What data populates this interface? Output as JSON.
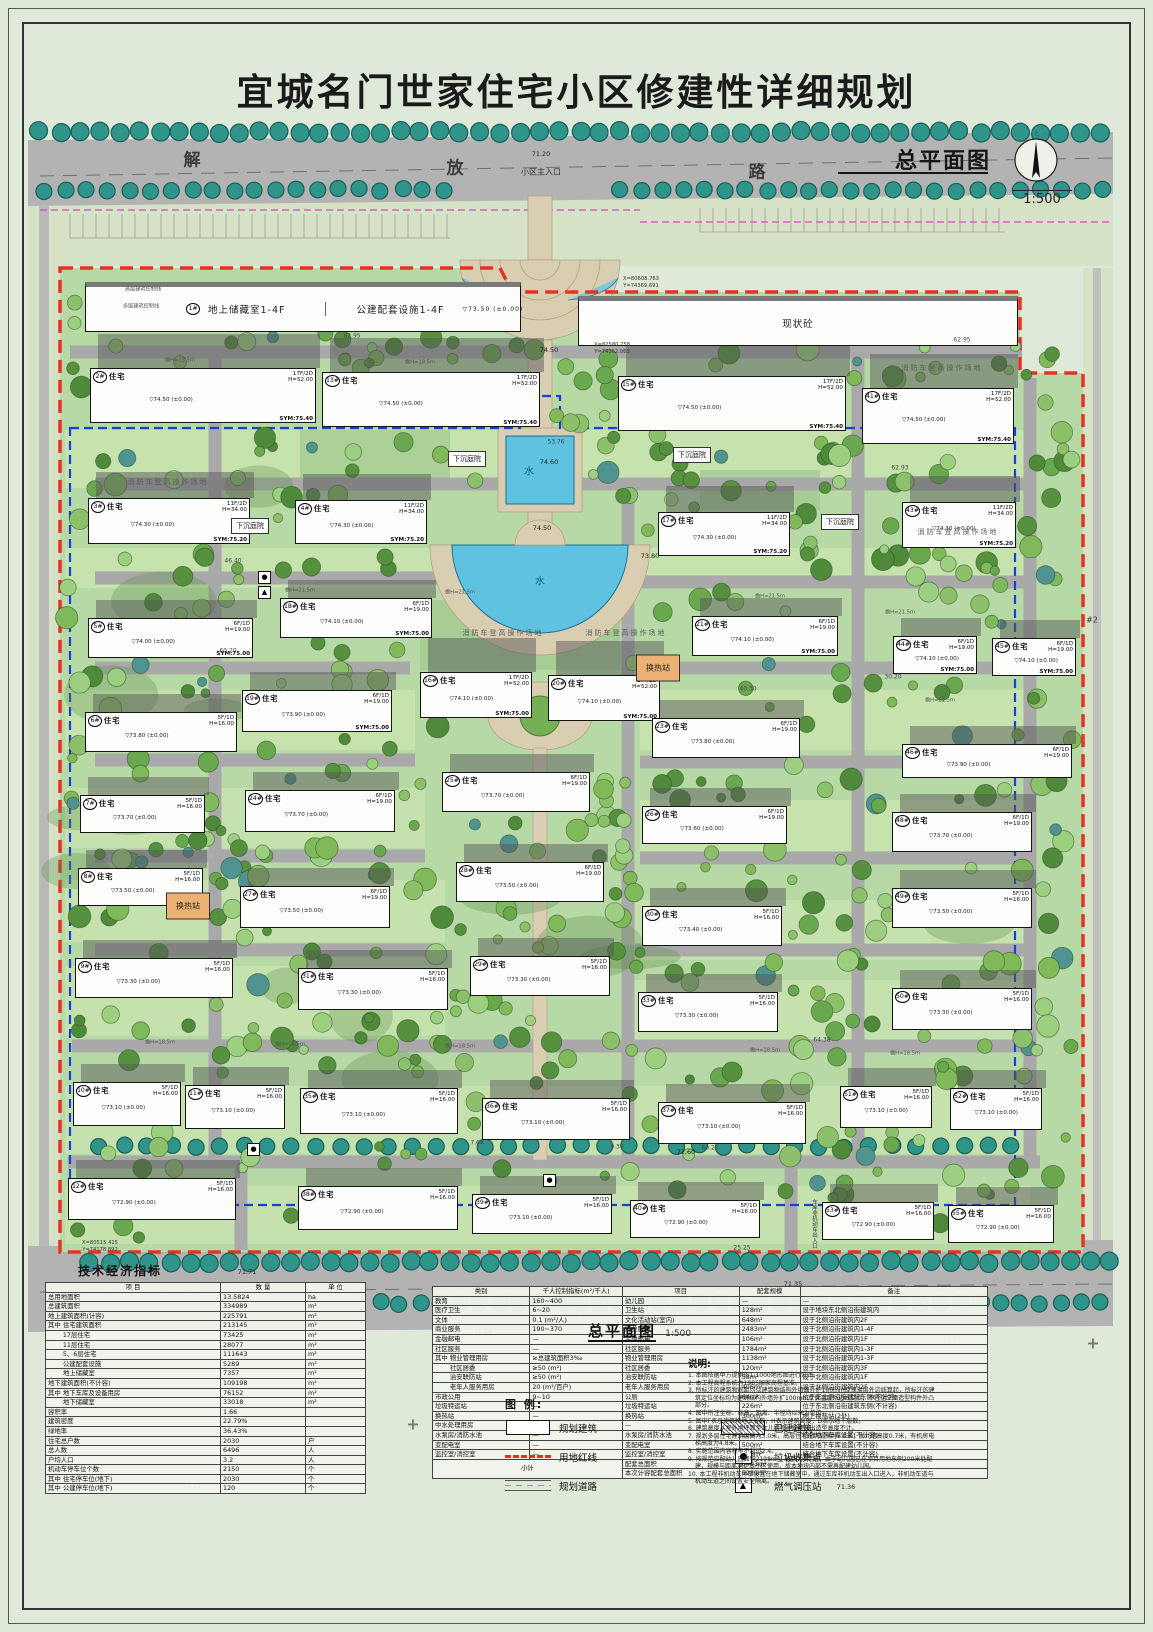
{
  "title": "宜城名门世家住宅小区修建性详细规划",
  "plan_label": {
    "name": "总平面图",
    "scale": "1:500",
    "north": "北"
  },
  "subtitle": {
    "name": "总平面图",
    "scale": "1:500"
  },
  "road": {
    "name": "解放路",
    "c1": "解",
    "c2": "放",
    "c3": "路"
  },
  "building_type": "住宅",
  "base_mark": "(±0.00)",
  "storage": {
    "num": "1#",
    "label1": "地上储藏室1-4F",
    "label2": "公建配套设施1-4F",
    "elev": "▽73.50 (±0.00)"
  },
  "existing": {
    "label": "现状砼"
  },
  "buildings": [
    {
      "n": "2#",
      "x": 90,
      "y": 368,
      "w": 226,
      "h": 55,
      "f": "17F/2D",
      "ht": "H=52.00",
      "e": "74.50",
      "s": "SYM:75.40"
    },
    {
      "n": "13#",
      "x": 322,
      "y": 372,
      "w": 218,
      "h": 55,
      "f": "17F/2D",
      "ht": "H=52.00",
      "e": "74.50",
      "s": "SYM:75.40"
    },
    {
      "n": "15#",
      "x": 618,
      "y": 376,
      "w": 228,
      "h": 55,
      "f": "17F/2D",
      "ht": "H=52.00",
      "e": "74.50",
      "s": "SYM:75.40"
    },
    {
      "n": "41#",
      "x": 862,
      "y": 388,
      "w": 152,
      "h": 56,
      "f": "17F/2D",
      "ht": "H=52.00",
      "e": "74.50",
      "s": "SYM:75.40"
    },
    {
      "n": "3#",
      "x": 88,
      "y": 498,
      "w": 162,
      "h": 46,
      "f": "11F/2D",
      "ht": "H=34.00",
      "e": "74.30",
      "s": "SYM:75.20"
    },
    {
      "n": "4#",
      "x": 295,
      "y": 500,
      "w": 132,
      "h": 44,
      "f": "11F/2D",
      "ht": "H=34.00",
      "e": "74.30",
      "s": "SYM:75.20"
    },
    {
      "n": "17#",
      "x": 658,
      "y": 512,
      "w": 132,
      "h": 44,
      "f": "11F/2D",
      "ht": "H=34.00",
      "e": "74.30",
      "s": "SYM:75.20"
    },
    {
      "n": "43#",
      "x": 902,
      "y": 502,
      "w": 114,
      "h": 46,
      "f": "11F/2D",
      "ht": "H=34.00",
      "e": "74.30",
      "s": "SYM:75.20"
    },
    {
      "n": "18#",
      "x": 280,
      "y": 598,
      "w": 152,
      "h": 40,
      "f": "6F/1D",
      "ht": "H=19.00",
      "e": "74.10",
      "s": "SYM:75.00"
    },
    {
      "n": "5#",
      "x": 88,
      "y": 618,
      "w": 165,
      "h": 40,
      "f": "6F/1D",
      "ht": "H=19.00",
      "e": "74.00",
      "s": "SYM:75.00"
    },
    {
      "n": "21#",
      "x": 692,
      "y": 616,
      "w": 146,
      "h": 40,
      "f": "6F/1D",
      "ht": "H=19.00",
      "e": "74.10",
      "s": "SYM:75.00"
    },
    {
      "n": "44#",
      "x": 893,
      "y": 636,
      "w": 84,
      "h": 38,
      "f": "6F/1D",
      "ht": "H=19.00",
      "e": "74.10",
      "s": "SYM:75.00"
    },
    {
      "n": "45#",
      "x": 992,
      "y": 638,
      "w": 84,
      "h": 38,
      "f": "6F/1D",
      "ht": "H=19.00",
      "e": "74.10",
      "s": "SYM:75.00"
    },
    {
      "n": "16#",
      "x": 420,
      "y": 672,
      "w": 112,
      "h": 46,
      "f": "17F/2D",
      "ht": "H=52.00",
      "e": "74.10",
      "s": "SYM:75.00"
    },
    {
      "n": "20#",
      "x": 548,
      "y": 675,
      "w": 112,
      "h": 46,
      "f": "17F/2D",
      "ht": "H=52.00",
      "e": "74.10",
      "s": "SYM:75.00"
    },
    {
      "n": "19#",
      "x": 242,
      "y": 690,
      "w": 150,
      "h": 42,
      "f": "6F/1D",
      "ht": "H=19.00",
      "e": "73.90",
      "s": "SYM:75.00"
    },
    {
      "n": "6#",
      "x": 85,
      "y": 712,
      "w": 152,
      "h": 40,
      "f": "5F/1D",
      "ht": "H=16.00",
      "e": "73.80"
    },
    {
      "n": "23#",
      "x": 652,
      "y": 718,
      "w": 148,
      "h": 40,
      "f": "6F/1D",
      "ht": "H=19.00",
      "e": "73.80"
    },
    {
      "n": "46#",
      "x": 902,
      "y": 744,
      "w": 170,
      "h": 34,
      "f": "6F/1D",
      "ht": "H=19.00",
      "e": "73.90"
    },
    {
      "n": "7#",
      "x": 80,
      "y": 795,
      "w": 125,
      "h": 38,
      "f": "5F/1D",
      "ht": "H=16.00",
      "e": "73.70"
    },
    {
      "n": "24#",
      "x": 245,
      "y": 790,
      "w": 150,
      "h": 42,
      "f": "6F/1D",
      "ht": "H=19.00",
      "e": "73.70"
    },
    {
      "n": "25#",
      "x": 442,
      "y": 772,
      "w": 148,
      "h": 40,
      "f": "6F/1D",
      "ht": "H=19.00",
      "e": "73.70"
    },
    {
      "n": "26#",
      "x": 642,
      "y": 806,
      "w": 145,
      "h": 38,
      "f": "6F/1D",
      "ht": "H=19.00",
      "e": "73.60"
    },
    {
      "n": "48#",
      "x": 892,
      "y": 812,
      "w": 140,
      "h": 40,
      "f": "6F/1D",
      "ht": "H=19.00",
      "e": "73.70"
    },
    {
      "n": "8#",
      "x": 78,
      "y": 868,
      "w": 125,
      "h": 38,
      "f": "5F/1D",
      "ht": "H=16.00",
      "e": "73.50"
    },
    {
      "n": "27#",
      "x": 240,
      "y": 886,
      "w": 150,
      "h": 42,
      "f": "6F/1D",
      "ht": "H=19.00",
      "e": "73.50"
    },
    {
      "n": "28#",
      "x": 456,
      "y": 862,
      "w": 148,
      "h": 40,
      "f": "6F/1D",
      "ht": "H=19.00",
      "e": "73.50"
    },
    {
      "n": "30#",
      "x": 642,
      "y": 906,
      "w": 140,
      "h": 40,
      "f": "5F/1D",
      "ht": "H=16.00",
      "e": "73.40"
    },
    {
      "n": "49#",
      "x": 892,
      "y": 888,
      "w": 140,
      "h": 40,
      "f": "5F/1D",
      "ht": "H=16.00",
      "e": "73.50"
    },
    {
      "n": "9#",
      "x": 75,
      "y": 958,
      "w": 158,
      "h": 40,
      "f": "5F/1D",
      "ht": "H=16.00",
      "e": "73.30"
    },
    {
      "n": "31#",
      "x": 298,
      "y": 968,
      "w": 150,
      "h": 42,
      "f": "5F/1D",
      "ht": "H=16.00",
      "e": "73.30"
    },
    {
      "n": "29#",
      "x": 470,
      "y": 956,
      "w": 140,
      "h": 40,
      "f": "5F/1D",
      "ht": "H=16.00",
      "e": "73.30"
    },
    {
      "n": "33#",
      "x": 638,
      "y": 992,
      "w": 140,
      "h": 40,
      "f": "5F/1D",
      "ht": "H=16.00",
      "e": "73.30"
    },
    {
      "n": "50#",
      "x": 892,
      "y": 988,
      "w": 140,
      "h": 42,
      "f": "5F/1D",
      "ht": "H=16.00",
      "e": "73.30"
    },
    {
      "n": "10#",
      "x": 73,
      "y": 1082,
      "w": 108,
      "h": 44,
      "f": "5F/1D",
      "ht": "H=16.00",
      "e": "73.10"
    },
    {
      "n": "11#",
      "x": 185,
      "y": 1085,
      "w": 100,
      "h": 44,
      "f": "5F/1D",
      "ht": "H=16.00",
      "e": "73.10"
    },
    {
      "n": "35#",
      "x": 300,
      "y": 1088,
      "w": 158,
      "h": 46,
      "f": "5F/1D",
      "ht": "H=16.00",
      "e": "73.10"
    },
    {
      "n": "36#",
      "x": 482,
      "y": 1098,
      "w": 148,
      "h": 42,
      "f": "5F/1D",
      "ht": "H=16.00",
      "e": "73.10"
    },
    {
      "n": "37#",
      "x": 658,
      "y": 1102,
      "w": 148,
      "h": 42,
      "f": "5F/1D",
      "ht": "H=16.00",
      "e": "73.10"
    },
    {
      "n": "51#",
      "x": 840,
      "y": 1086,
      "w": 92,
      "h": 42,
      "f": "5F/1D",
      "ht": "H=16.00",
      "e": "73.10"
    },
    {
      "n": "52#",
      "x": 950,
      "y": 1088,
      "w": 92,
      "h": 42,
      "f": "5F/1D",
      "ht": "H=16.00",
      "e": "73.10"
    },
    {
      "n": "12#",
      "x": 68,
      "y": 1178,
      "w": 168,
      "h": 42,
      "f": "5F/1D",
      "ht": "H=16.00",
      "e": "72.90"
    },
    {
      "n": "38#",
      "x": 298,
      "y": 1186,
      "w": 160,
      "h": 44,
      "f": "5F/1D",
      "ht": "H=16.00",
      "e": "72.90"
    },
    {
      "n": "39#",
      "x": 472,
      "y": 1194,
      "w": 140,
      "h": 40,
      "f": "5F/1D",
      "ht": "H=16.00",
      "e": "73.10"
    },
    {
      "n": "40#",
      "x": 630,
      "y": 1200,
      "w": 130,
      "h": 38,
      "f": "5F/1D",
      "ht": "H=16.00",
      "e": "72.90"
    },
    {
      "n": "53#",
      "x": 822,
      "y": 1202,
      "w": 112,
      "h": 38,
      "f": "5F/1D",
      "ht": "H=16.00",
      "e": "72.90"
    },
    {
      "n": "55#",
      "x": 948,
      "y": 1205,
      "w": 106,
      "h": 38,
      "f": "5F/1D",
      "ht": "H=16.00",
      "e": "72.90"
    }
  ],
  "annotations": [
    {
      "t": "小区主入口",
      "x": 541,
      "y": 172,
      "c": "lbl"
    },
    {
      "t": "71.20",
      "x": 541,
      "y": 154,
      "c": "elev"
    },
    {
      "t": "小区次入口",
      "x": 243,
      "y": 1290,
      "c": "lbl"
    },
    {
      "t": "71.71",
      "x": 247,
      "y": 1272,
      "c": "elev"
    },
    {
      "t": "小区次入口",
      "x": 795,
      "y": 1302,
      "c": "lbl"
    },
    {
      "t": "71.35",
      "x": 793,
      "y": 1284,
      "c": "elev"
    },
    {
      "t": "消防车登高操作场地",
      "x": 168,
      "y": 482,
      "c": "fire"
    },
    {
      "t": "消防车登高操作场地",
      "x": 503,
      "y": 633,
      "c": "fire"
    },
    {
      "t": "消防车登高操作场地",
      "x": 626,
      "y": 633,
      "c": "fire"
    },
    {
      "t": "消防车登高操作场地",
      "x": 942,
      "y": 368,
      "c": "fire"
    },
    {
      "t": "消防车登高操作场地",
      "x": 958,
      "y": 532,
      "c": "fire"
    },
    {
      "t": "下沉庭院",
      "x": 467,
      "y": 459,
      "c": "box"
    },
    {
      "t": "下沉庭院",
      "x": 692,
      "y": 455,
      "c": "box"
    },
    {
      "t": "下沉庭院",
      "x": 250,
      "y": 526,
      "c": "box"
    },
    {
      "t": "下沉庭院",
      "x": 840,
      "y": 522,
      "c": "box"
    },
    {
      "t": "换热站",
      "x": 658,
      "y": 668,
      "c": "hx"
    },
    {
      "t": "换热站",
      "x": 188,
      "y": 906,
      "c": "hx"
    },
    {
      "t": "水",
      "x": 529,
      "y": 470,
      "c": "wlbl"
    },
    {
      "t": "74.60",
      "x": 549,
      "y": 462,
      "c": "elev"
    },
    {
      "t": "水",
      "x": 540,
      "y": 580,
      "c": "wlbl"
    },
    {
      "t": "74.50",
      "x": 542,
      "y": 528,
      "c": "elev"
    },
    {
      "t": "X=80608.763",
      "x": 641,
      "y": 279,
      "c": "coord"
    },
    {
      "t": "Y=74369.691",
      "x": 641,
      "y": 286,
      "c": "coord"
    },
    {
      "t": "X=82580.758",
      "x": 612,
      "y": 345,
      "c": "coord"
    },
    {
      "t": "Y=74362.063",
      "x": 612,
      "y": 352,
      "c": "coord"
    },
    {
      "t": "X=80515.415",
      "x": 100,
      "y": 1243,
      "c": "coord"
    },
    {
      "t": "Y=74178.892",
      "x": 100,
      "y": 1250,
      "c": "coord"
    },
    {
      "t": "高层建筑控制线",
      "x": 143,
      "y": 289,
      "c": "tiny"
    },
    {
      "t": "多层建筑控制线",
      "x": 141,
      "y": 306,
      "c": "tiny"
    },
    {
      "t": "62.95",
      "x": 352,
      "y": 336,
      "c": "dim"
    },
    {
      "t": "62.95",
      "x": 962,
      "y": 340,
      "c": "dim"
    },
    {
      "t": "62.93",
      "x": 900,
      "y": 468,
      "c": "dim"
    },
    {
      "t": "46.40",
      "x": 233,
      "y": 561,
      "c": "dim"
    },
    {
      "t": "60.20",
      "x": 228,
      "y": 651,
      "c": "dim"
    },
    {
      "t": "40.30",
      "x": 748,
      "y": 689,
      "c": "dim"
    },
    {
      "t": "30.20",
      "x": 893,
      "y": 677,
      "c": "dim"
    },
    {
      "t": "64.38",
      "x": 822,
      "y": 1040,
      "c": "dim"
    },
    {
      "t": "25.25",
      "x": 742,
      "y": 1248,
      "c": "dim"
    },
    {
      "t": "53.76",
      "x": 556,
      "y": 442,
      "c": "dim"
    },
    {
      "t": "7.64",
      "x": 477,
      "y": 1143,
      "c": "dim"
    },
    {
      "t": "9.30",
      "x": 617,
      "y": 1147,
      "c": "dim"
    },
    {
      "t": "80.20",
      "x": 710,
      "y": 1148,
      "c": "dim"
    },
    {
      "t": "檐H=18.5m",
      "x": 160,
      "y": 1042,
      "c": "tiny"
    },
    {
      "t": "檐H=18.5m",
      "x": 290,
      "y": 1044,
      "c": "tiny"
    },
    {
      "t": "檐H=18.5m",
      "x": 460,
      "y": 1046,
      "c": "tiny"
    },
    {
      "t": "檐H=18.5m",
      "x": 765,
      "y": 1050,
      "c": "tiny"
    },
    {
      "t": "檐H=18.5m",
      "x": 905,
      "y": 1053,
      "c": "tiny"
    },
    {
      "t": "檐H=21.5m",
      "x": 300,
      "y": 590,
      "c": "tiny"
    },
    {
      "t": "檐H=21.5m",
      "x": 460,
      "y": 592,
      "c": "tiny"
    },
    {
      "t": "檐H=21.5m",
      "x": 770,
      "y": 596,
      "c": "tiny"
    },
    {
      "t": "檐H=21.5m",
      "x": 940,
      "y": 700,
      "c": "tiny"
    },
    {
      "t": "檐H=18.5m",
      "x": 180,
      "y": 360,
      "c": "tiny"
    },
    {
      "t": "檐H=18.5m",
      "x": 420,
      "y": 362,
      "c": "tiny"
    },
    {
      "t": "檐H=21.5m",
      "x": 900,
      "y": 612,
      "c": "tiny"
    },
    {
      "t": "71.72",
      "x": 580,
      "y": 1316,
      "c": "elev"
    },
    {
      "t": "71.48",
      "x": 483,
      "y": 1332,
      "c": "elev"
    },
    {
      "t": "71.44",
      "x": 549,
      "y": 1383,
      "c": "elev"
    },
    {
      "t": "71.59",
      "x": 729,
      "y": 1368,
      "c": "elev"
    },
    {
      "t": "71.44",
      "x": 874,
      "y": 1387,
      "c": "elev"
    },
    {
      "t": "71.48",
      "x": 449,
      "y": 1419,
      "c": "elev"
    },
    {
      "t": "71.36",
      "x": 846,
      "y": 1487,
      "c": "elev"
    },
    {
      "t": "71.40",
      "x": 830,
      "y": 1437,
      "c": "elev"
    },
    {
      "t": "71.51",
      "x": 952,
      "y": 1337,
      "c": "elev"
    },
    {
      "t": "71.21",
      "x": 192,
      "y": 1486,
      "c": "elev"
    },
    {
      "t": "71.36",
      "x": 940,
      "y": 1384,
      "c": "elev"
    },
    {
      "t": "73.80",
      "x": 650,
      "y": 556,
      "c": "elev"
    },
    {
      "t": "74.50",
      "x": 549,
      "y": 350,
      "c": "elev"
    },
    {
      "t": "72.60",
      "x": 686,
      "y": 1152,
      "c": "elev"
    },
    {
      "t": "#2",
      "x": 1092,
      "y": 620,
      "c": "lbl"
    },
    {
      "t": "#2",
      "x": 676,
      "y": 1318,
      "c": "lbl"
    },
    {
      "t": "车库非机动车出入口",
      "x": 814,
      "y": 1224,
      "c": "vert"
    },
    {
      "t": "+",
      "x": 413,
      "y": 1424,
      "c": "cross"
    },
    {
      "t": "+",
      "x": 857,
      "y": 1343,
      "c": "cross"
    },
    {
      "t": "+",
      "x": 1093,
      "y": 1343,
      "c": "cross"
    }
  ],
  "icons": [
    {
      "k": "dot",
      "x": 263,
      "y": 576
    },
    {
      "k": "tri",
      "x": 263,
      "y": 591
    },
    {
      "k": "dot",
      "x": 252,
      "y": 1148
    },
    {
      "k": "dot",
      "x": 548,
      "y": 1179
    }
  ],
  "indicators": {
    "title": "技术经济指标",
    "columns": [
      "项  目",
      "数  量",
      "单 位"
    ],
    "rows": [
      [
        "总用地面积",
        "13.5824",
        "ha"
      ],
      [
        "总建筑面积",
        "334989",
        "m²"
      ],
      [
        "地上建筑面积(计容)",
        "225791",
        "m²"
      ],
      [
        "其中 住宅建筑面积",
        "213145",
        "m²"
      ],
      [
        "　　 17层住宅",
        "73425",
        "m²"
      ],
      [
        "　　 11层住宅",
        "28077",
        "m²"
      ],
      [
        "　　 5、6层住宅",
        "111643",
        "m²"
      ],
      [
        "　　 公建配套设施",
        "5289",
        "m²"
      ],
      [
        "　　 地上储藏室",
        "7357",
        "m²"
      ],
      [
        "地下建筑面积(不计容)",
        "109198",
        "m²"
      ],
      [
        "其中 地下车库及设备用房",
        "76152",
        "m²"
      ],
      [
        "　　 地下储藏室",
        "33018",
        "m²"
      ],
      [
        "容积率",
        "1.66",
        ""
      ],
      [
        "建筑密度",
        "22.79%",
        ""
      ],
      [
        "绿地率",
        "36.43%",
        ""
      ],
      [
        "住宅总户数",
        "2030",
        "户"
      ],
      [
        "总人数",
        "6496",
        "人"
      ],
      [
        "户均人口",
        "3.2",
        "人"
      ],
      [
        "机动车停车位个数",
        "2150",
        "个"
      ],
      [
        "其中 住宅停车位(地下)",
        "2030",
        "个"
      ],
      [
        "其中 公建停车位(地下)",
        "120",
        "个"
      ]
    ]
  },
  "facilities": {
    "columns": [
      "类别",
      "千人控制指标(m²/千人)",
      "项目",
      "配套规模",
      "备注"
    ],
    "rows": [
      [
        "教育",
        "160~400",
        "幼儿园",
        "—",
        "—"
      ],
      [
        "医疗卫生",
        "6~20",
        "卫生站",
        "128m²",
        "设于地块东北侧沿街建筑内"
      ],
      [
        "文体",
        "0.1 (m²/人)",
        "文化活动站(室内)",
        "648m²",
        "设于北侧沿街建筑内2F"
      ],
      [
        "商业服务",
        "190~370",
        "商业服务",
        "2483m²",
        "设于北侧沿街建筑内1-4F"
      ],
      [
        "金融邮电",
        "—",
        "金融邮电",
        "106m²",
        "设于北侧沿街建筑内1F"
      ],
      [
        "社区服务",
        "—",
        "社区服务",
        "1784m²",
        "设于北侧沿街建筑内1-3F"
      ],
      [
        "其中 物业管理用房",
        "≥总建筑面积3‰",
        "物业管理用房",
        "1138m²",
        "设于北侧沿街建筑内1-3F"
      ],
      [
        "　　 社区居委",
        "≥50 (m²)",
        "社区居委",
        "120m²",
        "设于北侧沿街建筑内3F"
      ],
      [
        "　　 治安联防站",
        "≥50 (m²)",
        "治安联防站",
        "58m²",
        "设于北侧沿街建筑内1F"
      ],
      [
        "　　 老年人服务用房",
        "20 (m²/百户)",
        "老年人服务用房",
        "406m²",
        "设于北侧沿街建筑内2F"
      ],
      [
        "市政公用",
        "9~10",
        "公厕",
        "64m²",
        "位于东北侧沿街建筑东侧(不计容)"
      ],
      [
        "垃圾特运站",
        "—",
        "垃圾特运站",
        "226m²",
        "位于东北侧沿街建筑东侧(不计容)"
      ],
      [
        "换热站",
        "—",
        "换热站",
        "300m²",
        "地上换热站(2处)"
      ],
      [
        "中水处理用房",
        "—",
        "—",
        "—",
        "—"
      ],
      [
        "水泵房/消防水池",
        "—",
        "水泵房/消防水池",
        "200m²",
        "结合地下车库设置(不计容)"
      ],
      [
        "变配电室",
        "—",
        "变配电室",
        "500m²",
        "结合地下车库设置(不计容)"
      ],
      [
        "监控室/消控室",
        "—",
        "监控室/消控室",
        "128m²",
        "结合地下车库设置(不计容)"
      ]
    ],
    "footer_label": "小计",
    "footer": [
      [
        "配套总面积",
        "6403m²"
      ],
      [
        "本次计容配套总面积",
        "5289m²"
      ]
    ]
  },
  "legend": {
    "title": "图 例:",
    "items": [
      {
        "name": "规划建筑",
        "icon": "planned-building"
      },
      {
        "name": "已建建筑",
        "icon": "existing-building"
      },
      {
        "name": "用地红线",
        "icon": "red-line"
      },
      {
        "name": "垃圾收集点",
        "icon": "garbage-point"
      },
      {
        "name": "规划道路",
        "icon": "planned-road"
      },
      {
        "name": "燃气调压站",
        "icon": "gas-station"
      }
    ]
  },
  "notes": {
    "title": "说明:",
    "items": [
      "本图依据甲方提供的1:1000地形图进行设计。",
      "本工程高程系统为1985国家高程基准。",
      "所标注的建筑物间距均以建筑物结构外墙面外扩100mm厚保温层外边线算起，所标注的建筑定位坐标均为建筑结构外墙外扩100mm厚保温层外边线交点，不包括立面造型构件外凸部分。",
      "图中所注坐标、标高、距离、半径均以米为单位。",
      "图中F表示建筑物地上层数，H表示建筑高度，D表示地下层数。",
      "建筑高度从室外地坪算至女儿墙顶，局部突出造型高度不计。",
      "规划多层住宅建筑层高为3.0米，高层住宅建筑层高为3.0米；女儿墙高度0.7米，有机房电梯高度为4.8米。",
      "实施范围内容积率不超过2.4。",
      "按规范应配幼儿园面积2198m²，班数为6个班。由于幼儿园已在项目用地东侧200米处配建，规模与距离满足本小区使用，故本地块内部不需再配建幼儿园。",
      "本工程非机动车停车设置在地下储藏室中，通过车库非机动车出入口进入，非机动车道与机动车道之间设置安全隔离。"
    ]
  },
  "colors": {
    "site_green": "#b6d9a5",
    "road_gray": "#b3b3b3",
    "water_blue": "#5fc2e0",
    "red_line": "#e63224",
    "garage_blue": "#1840d8",
    "paving_beige": "#d9cdb2",
    "street_tree": "#2f9489"
  }
}
